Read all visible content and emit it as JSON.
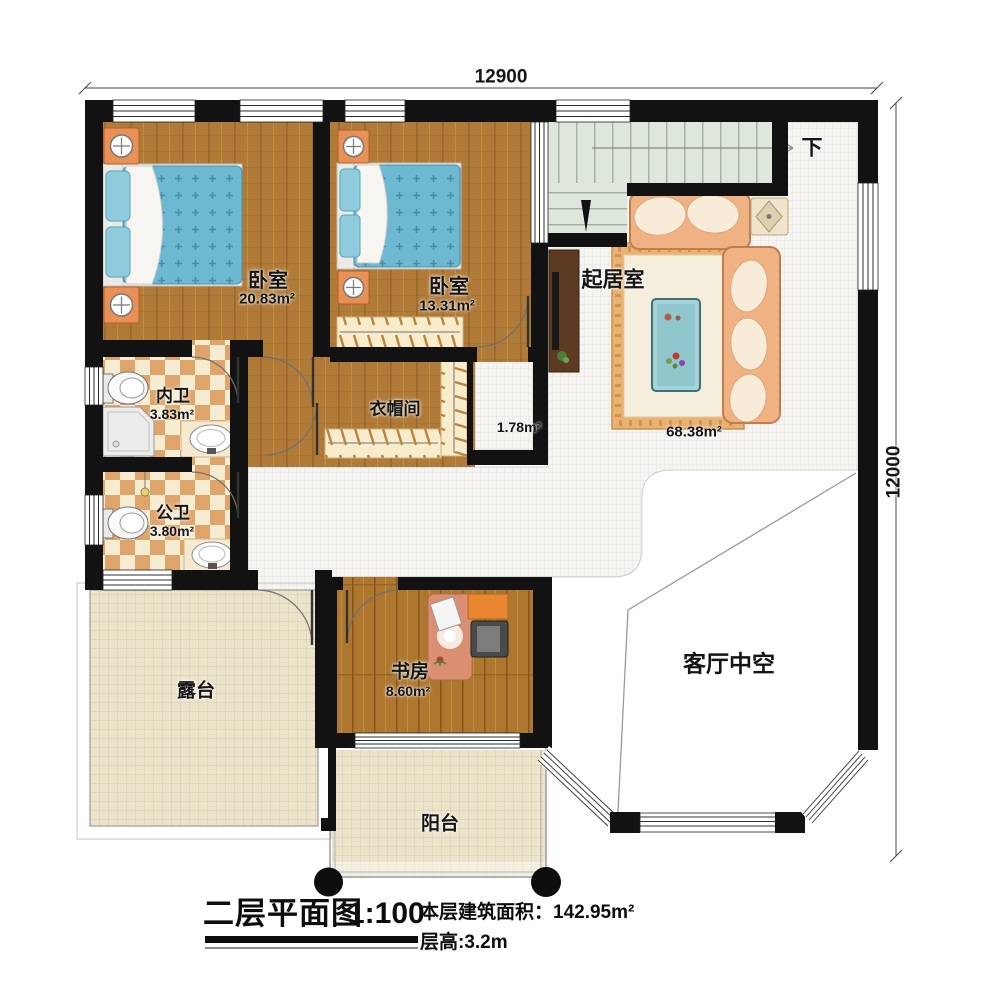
{
  "dimensions": {
    "top": "12900",
    "right": "12000"
  },
  "rooms": {
    "bedroom_master": {
      "name": "卧室",
      "area": "20.83m²"
    },
    "bedroom_second": {
      "name": "卧室",
      "area": "13.31m²"
    },
    "living_room": {
      "name": "起居室",
      "area": "68.38m²"
    },
    "bath_private": {
      "name": "内卫",
      "area": "3.83m²"
    },
    "bath_public": {
      "name": "公卫",
      "area": "3.80m²"
    },
    "cloakroom": {
      "name": "衣帽间",
      "area": "1.78m²"
    },
    "study": {
      "name": "书房",
      "area": "8.60m²"
    },
    "terrace": {
      "name": "露台"
    },
    "balcony": {
      "name": "阳台"
    },
    "atrium": {
      "name": "客厅中空"
    }
  },
  "stairs": {
    "direction_label": "下"
  },
  "titleblock": {
    "title": "二层平面图",
    "scale": "1:100",
    "floor_area_label": "本层建筑面积：",
    "floor_area_value": "142.95m²",
    "floor_height": "层高:3.2m"
  },
  "colors": {
    "wall": "#121212",
    "wood": "#b07a38",
    "wood_study": "#ad7730",
    "tile": "#f5f4f1",
    "terrace_tile": "#ebe4ca",
    "bath_dark": "#dfa469",
    "bath_light": "#f6ecd1",
    "stair_green": "#dfe6db",
    "bed_blue": "#6db9d2",
    "sofa_peach": "#f0b183",
    "desk_salmon": "#db8f72"
  }
}
